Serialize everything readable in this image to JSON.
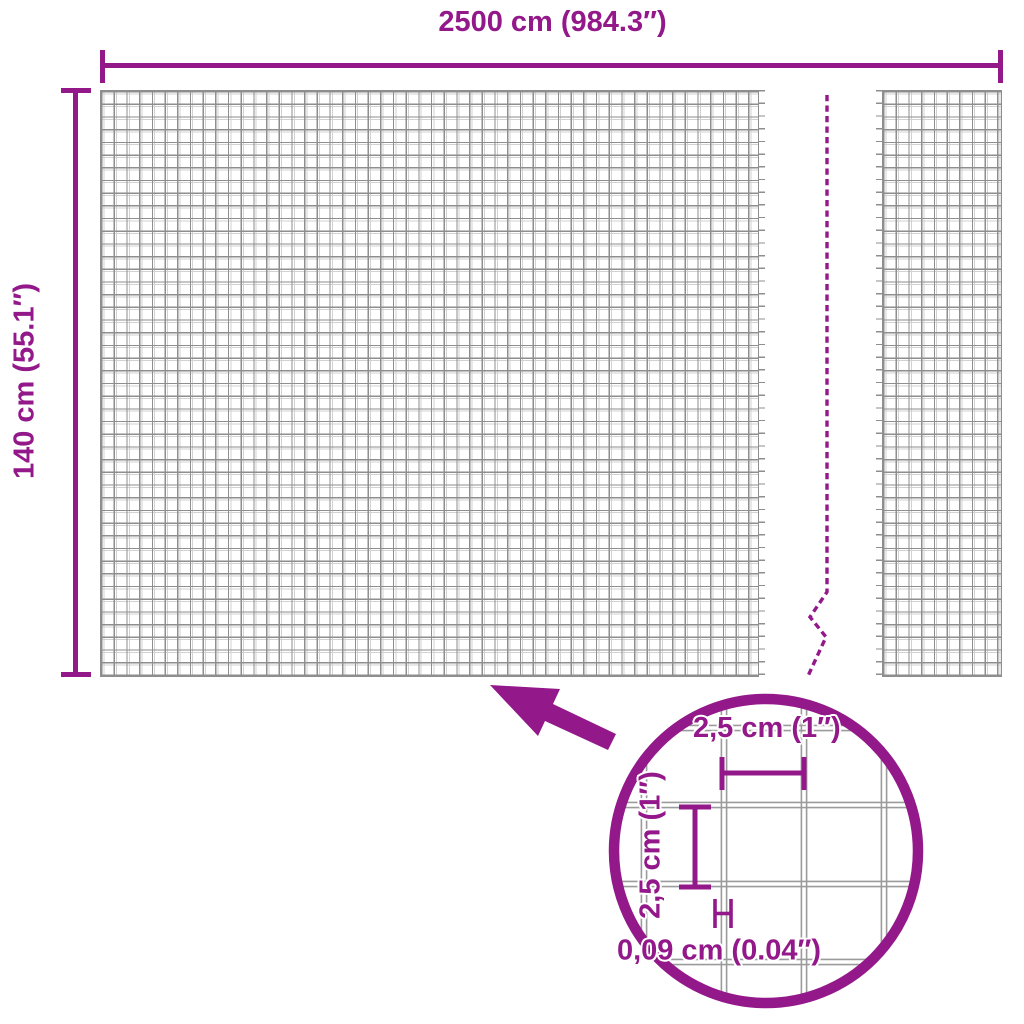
{
  "colors": {
    "accent": "#93188a",
    "wire": "#8e8e8e",
    "wire_light": "#d2d2d2",
    "detail_wire": "#9b9b9b",
    "background": "#ffffff"
  },
  "overall_dimensions": {
    "width_label": "2500 cm (984.3″)",
    "height_label": "140 cm (55.1″)"
  },
  "detail_view": {
    "cell_width_label": "2,5 cm (1″)",
    "cell_height_label": "2,5 cm (1″)",
    "wire_thickness_label": "0,09 cm (0.04″)"
  }
}
